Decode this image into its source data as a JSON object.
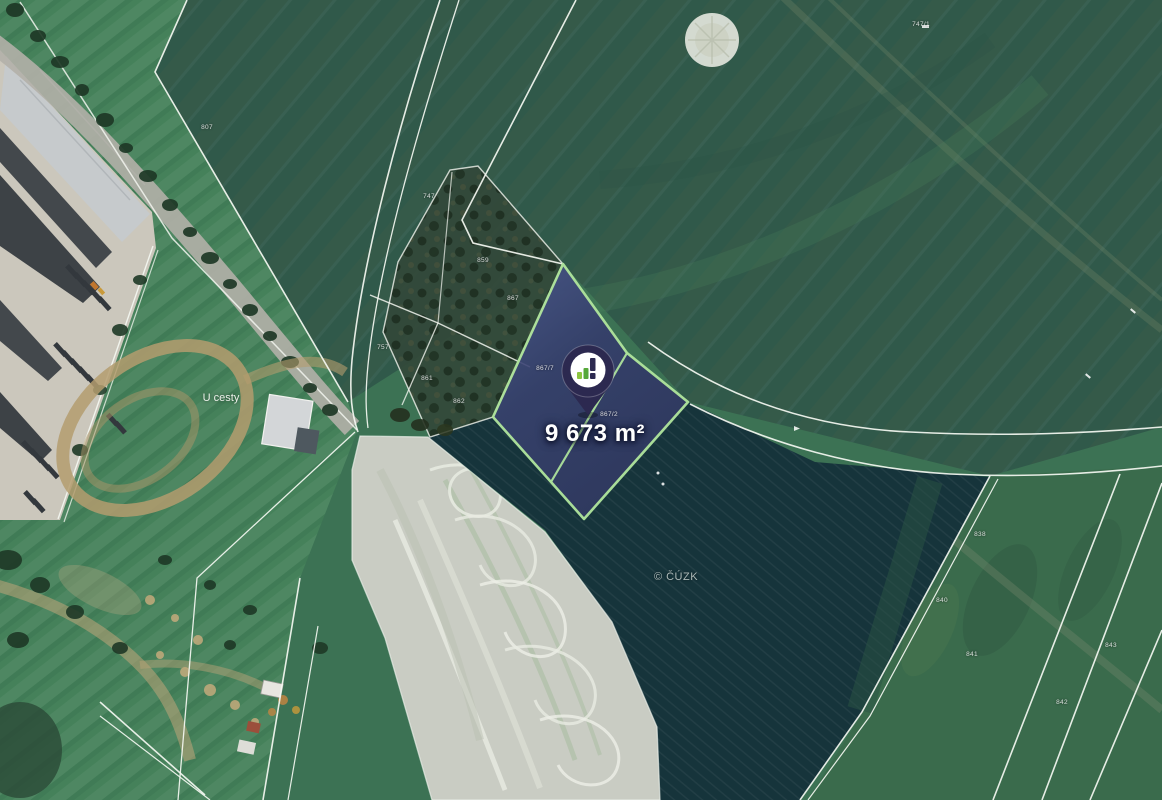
{
  "parcel": {
    "area_label": "9 673 m²",
    "fill_color": "#333A68",
    "border_color": "#ADE29B"
  },
  "pin": {
    "icon": "bar-chart-logo-pin",
    "body_color": "#2C2950",
    "logo_green_light": "#8DC63F",
    "logo_green_dark": "#56A839"
  },
  "map": {
    "place_label": "U cesty",
    "watermark": "© ČÚZK",
    "parcel_numbers": [
      {
        "text": "747",
        "x": 429,
        "y": 197
      },
      {
        "text": "859",
        "x": 483,
        "y": 261
      },
      {
        "text": "867",
        "x": 513,
        "y": 299
      },
      {
        "text": "757",
        "x": 383,
        "y": 348
      },
      {
        "text": "861",
        "x": 427,
        "y": 379
      },
      {
        "text": "862",
        "x": 459,
        "y": 402
      },
      {
        "text": "867/7",
        "x": 545,
        "y": 369
      },
      {
        "text": "867/2",
        "x": 609,
        "y": 415
      },
      {
        "text": "747/1",
        "x": 921,
        "y": 25
      },
      {
        "text": "838",
        "x": 980,
        "y": 535
      },
      {
        "text": "840",
        "x": 942,
        "y": 601
      },
      {
        "text": "841",
        "x": 972,
        "y": 655
      },
      {
        "text": "843",
        "x": 1111,
        "y": 646
      },
      {
        "text": "842",
        "x": 1062,
        "y": 703
      },
      {
        "text": "807",
        "x": 207,
        "y": 128
      }
    ]
  }
}
